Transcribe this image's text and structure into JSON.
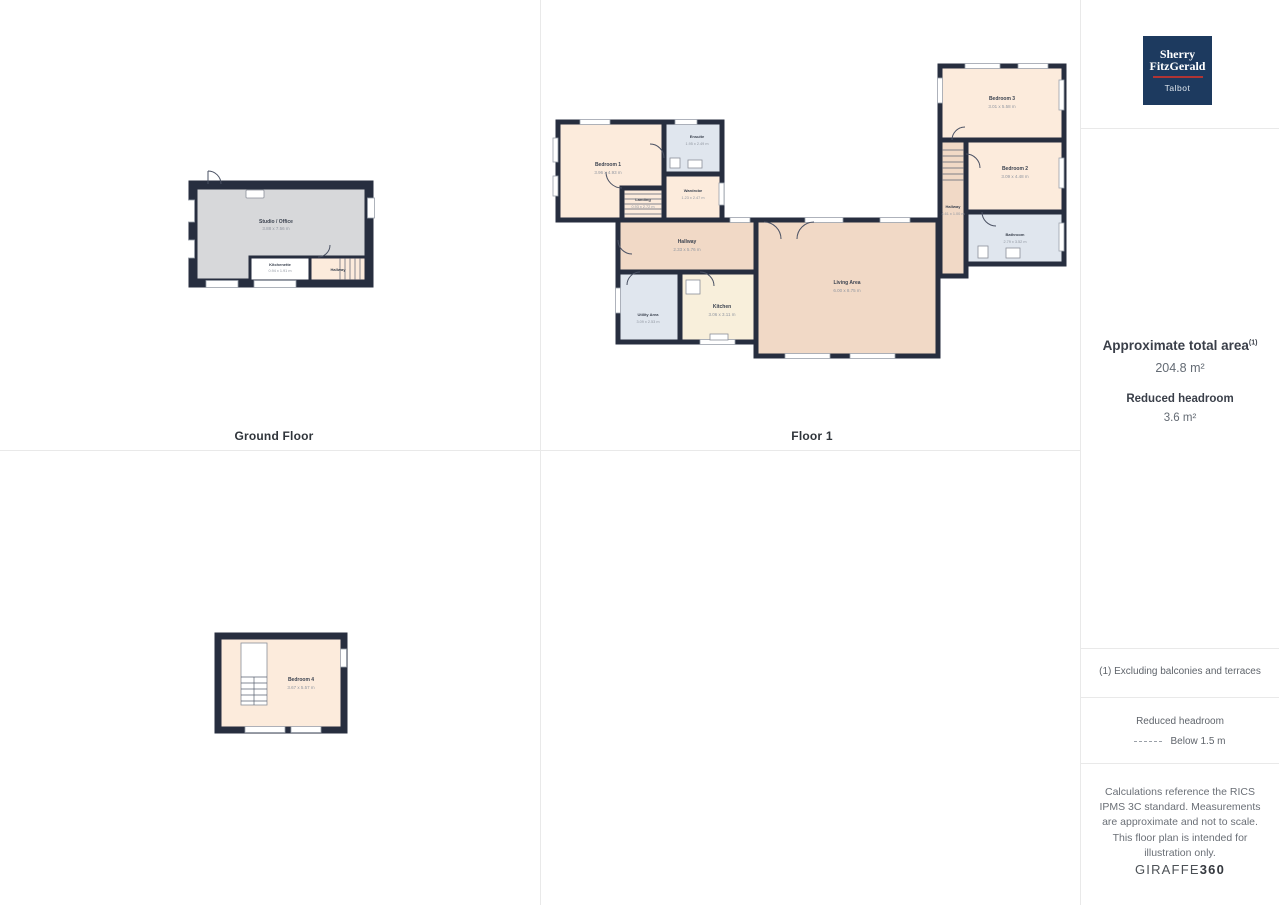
{
  "captions": {
    "ground": "Ground Floor",
    "floor1": "Floor 1"
  },
  "ground": {
    "studio": {
      "name": "Studio / Office",
      "dims": "3.88 x 7.56 m"
    },
    "kitchenette": {
      "name": "Kitchenette",
      "dims": "0.94 x 1.91 m"
    },
    "hallway": {
      "name": "Hallway"
    }
  },
  "floor1": {
    "bedroom1": {
      "name": "Bedroom 1",
      "dims": "3.96 x 4.93 m"
    },
    "ensuite": {
      "name": "Ensuite",
      "dims": "1.95 x 2.49 m"
    },
    "wardrobe": {
      "name": "Wardrobe",
      "dims": "1.23 x 2.47 m"
    },
    "landing": {
      "name": "Landing",
      "dims": "0.93 x 2.72 m"
    },
    "hallway": {
      "name": "Hallway",
      "dims": "2.33 x 5.76 m"
    },
    "utility": {
      "name": "Utility Area",
      "dims": "3.09 x 2.53 m"
    },
    "kitchen": {
      "name": "Kitchen",
      "dims": "3.06 x 3.11 m"
    },
    "living": {
      "name": "Living Area",
      "dims": "6.00 x 8.75 m"
    },
    "bedroom3": {
      "name": "Bedroom 3",
      "dims": "3.01 x 5.58 m"
    },
    "bedroom2": {
      "name": "Bedroom 2",
      "dims": "3.09 x 4.48 m"
    },
    "hallway2": {
      "name": "Hallway",
      "dims": "4.61 x 1.00 m"
    },
    "bathroom": {
      "name": "Bathroom",
      "dims": "2.79 x 3.52 m"
    }
  },
  "floor2": {
    "bedroom4": {
      "name": "Bedroom 4",
      "dims": "3.67 x 5.57 m"
    }
  },
  "sidebar": {
    "logo": {
      "line1": "Sherry",
      "line2": "FitzGerald",
      "line3": "Talbot"
    },
    "area_title": "Approximate total area",
    "area_sup": "(1)",
    "area_value": "204.8 m²",
    "headroom_title": "Reduced headroom",
    "headroom_value": "3.6 m²",
    "footnote": "(1) Excluding balconies and terraces",
    "legend_title": "Reduced headroom",
    "legend_label": "Below 1.5 m",
    "disclaimer": "Calculations reference the RICS IPMS 3C standard. Measurements are approximate and not to scale. This floor plan is intended for illustration only.",
    "brand_regular": "GIRAFFE",
    "brand_bold": "360"
  },
  "colors": {
    "wall": "#272e3f",
    "room_peach": "#fcebdc",
    "room_tan": "#f1d9c6",
    "room_blue": "#e0e6ee",
    "room_gray": "#d7d8da",
    "room_cream": "#f8efdb",
    "brand_navy": "#1d3a5f",
    "brand_red": "#b03434"
  }
}
